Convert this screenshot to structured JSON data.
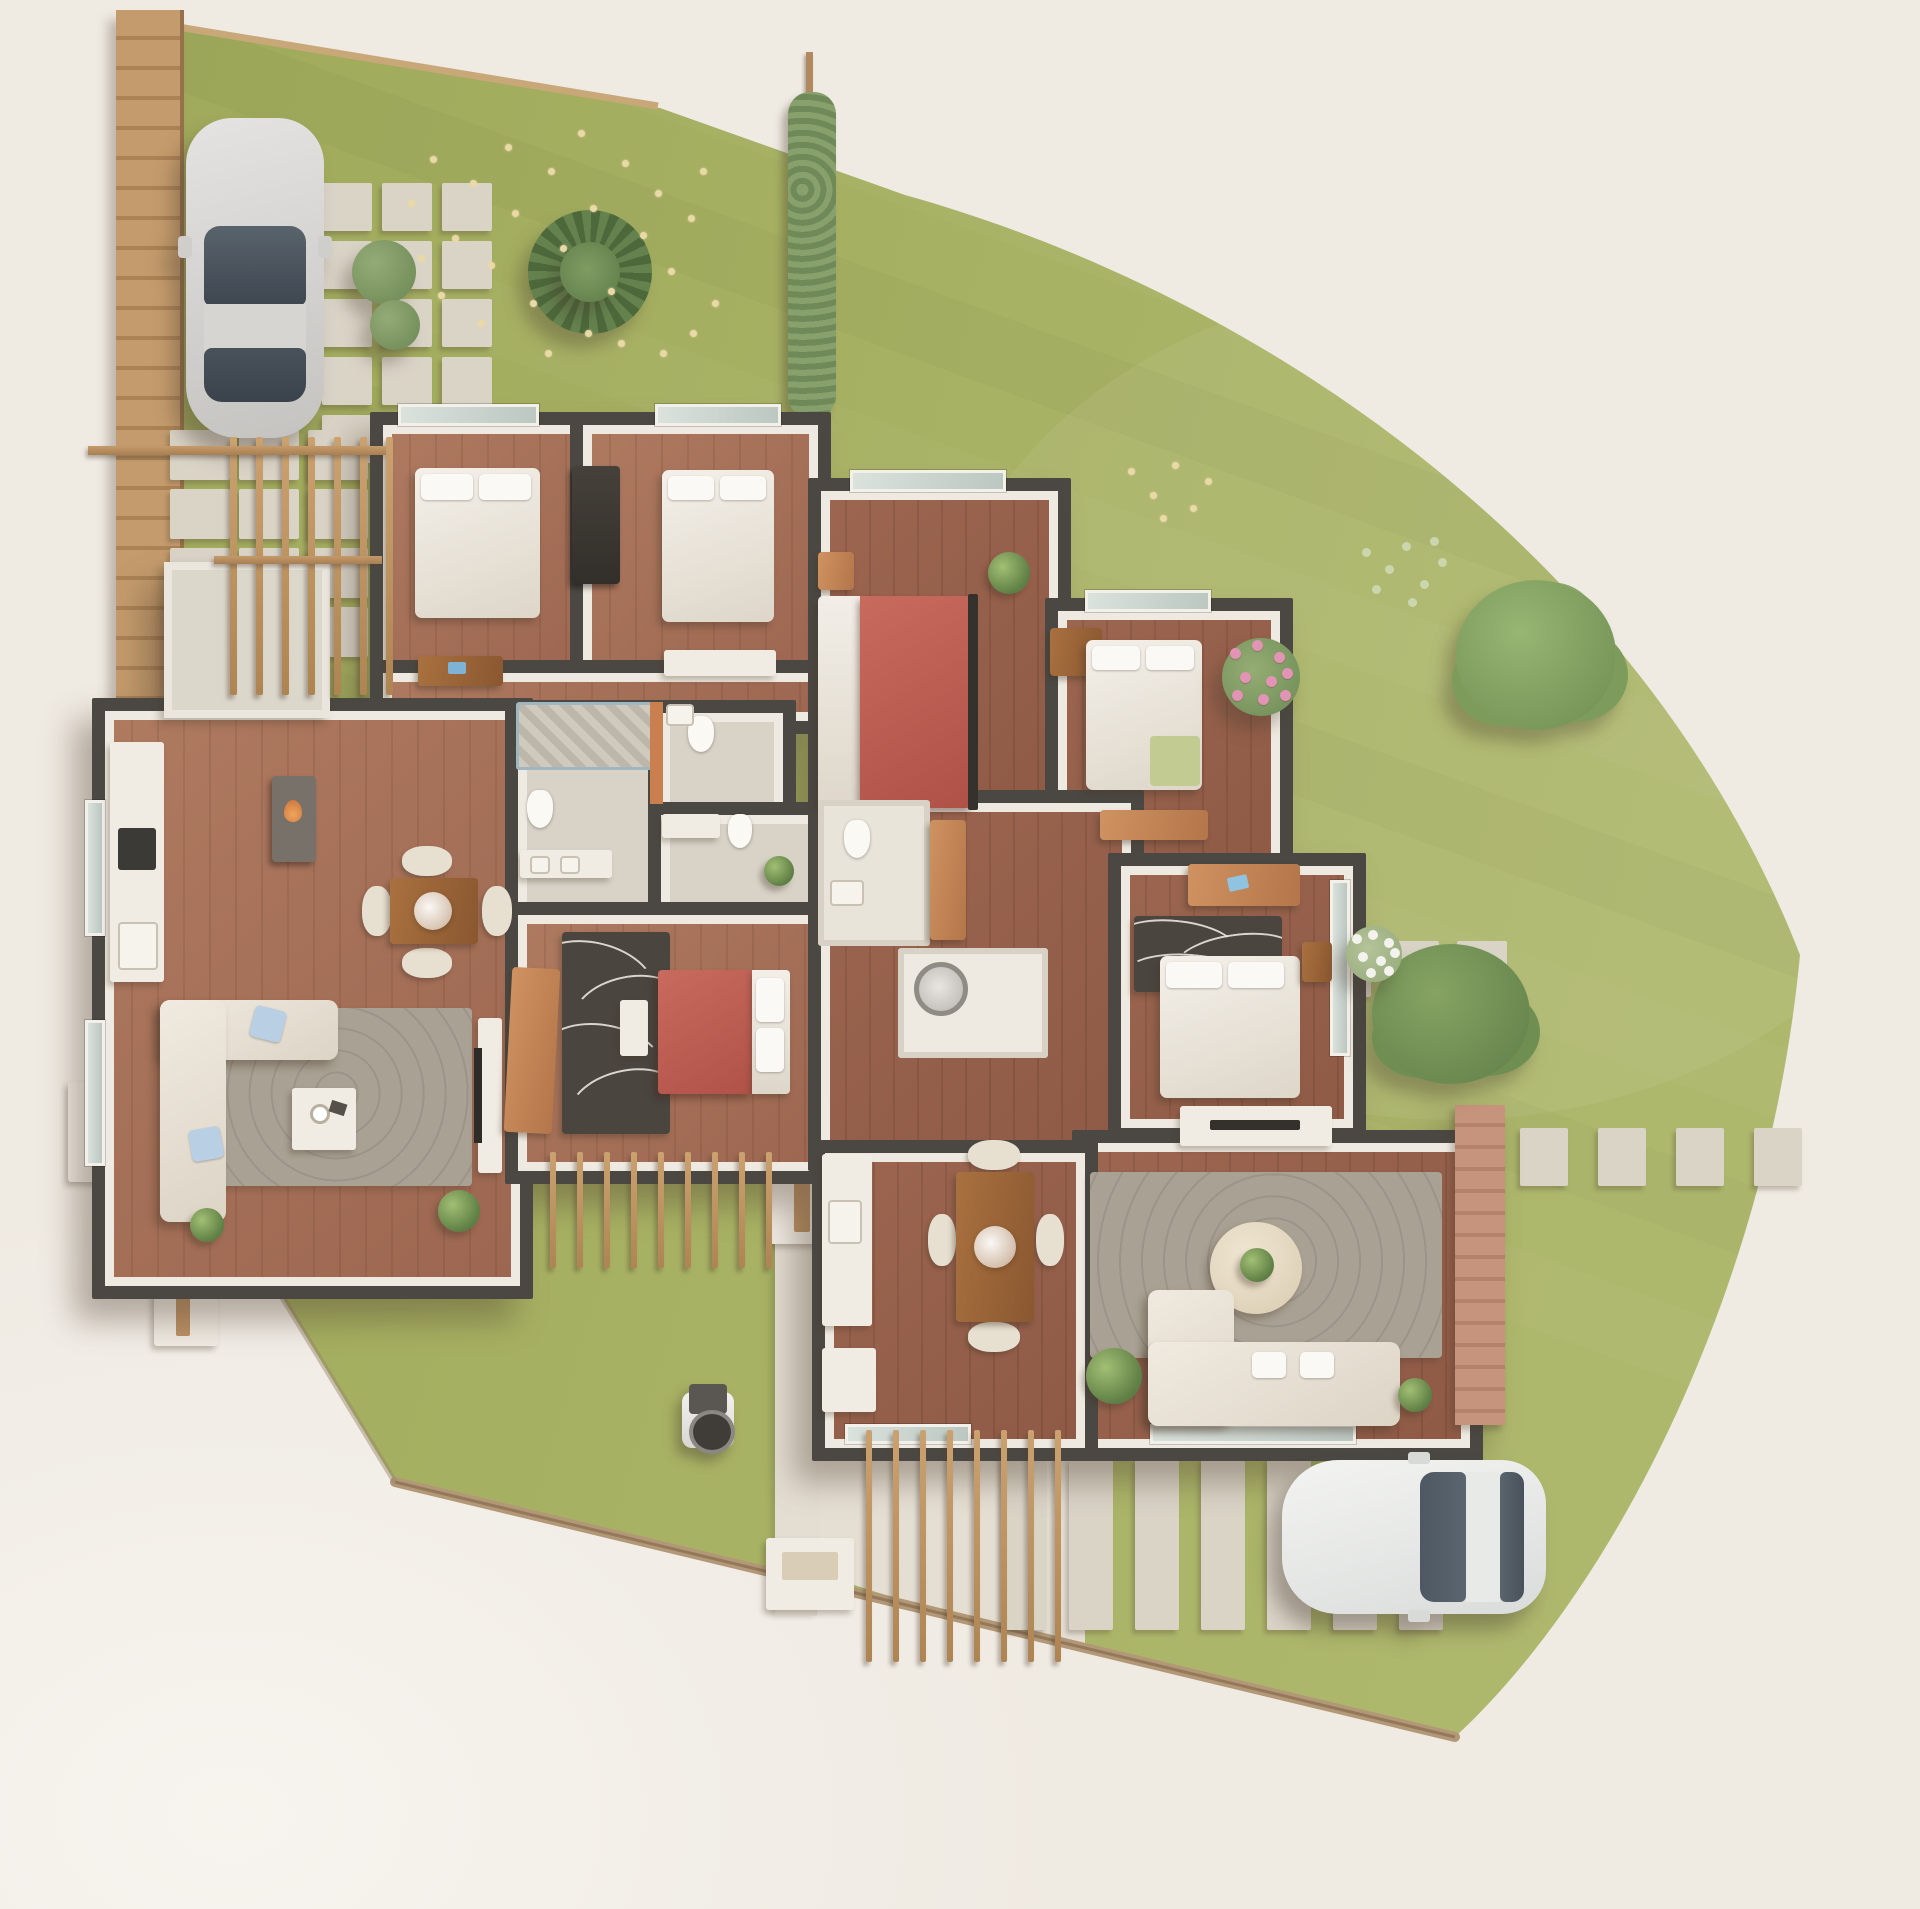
{
  "title": "3d-site-plan-two-unit-residence",
  "palette": {
    "bg": "#efeae2",
    "bg2": "#f7f4ef",
    "grass": "#a6b061",
    "grassd": "#99a556",
    "wall": "#4b4843",
    "wallin": "#efeae1",
    "woodA": "#ae7a60",
    "woodB": "#9c6650",
    "bath": "#d8d2c7",
    "white": "#f0ebe3",
    "cream": "#e8decb",
    "red": "#bf5e53",
    "rug": "#a9a193",
    "rugdark": "#4a453f",
    "wood": "#a06a42",
    "woodlt": "#c58a55",
    "orange": "#c9804e",
    "paver": "#dad4c7",
    "fence": "#bb9064",
    "hedge": "#7c9362",
    "glasscol": "#cdd7d1",
    "dirt": "#b29877",
    "pink": "#e294b4",
    "carbody": "#d9d8d5",
    "carglass": "#515c66",
    "car2body": "#f0f1ef"
  },
  "scene": {
    "lot_path": "M148,22 L660,108 L905,195 C1280,300 1650,570 1800,955 C1768,1292 1612,1592 1455,1737 L395,1482 L165,1105 Z",
    "curb_path": "M395,1482 L1455,1737",
    "edge_top_path": "M148,22 L658,106",
    "driveway_points": "775,1428 1085,1428 1085,1658 775,1560",
    "walkway": {
      "x": 775,
      "y": 1148,
      "w": 42,
      "h": 468
    },
    "fence": {
      "x": 116,
      "y": 10,
      "w": 64,
      "h": 1098
    },
    "hedge": {
      "x": 788,
      "y": 92,
      "w": 48,
      "h": 326
    },
    "hedge_post": {
      "x": 806,
      "y": 52,
      "w": 7,
      "h": 380
    },
    "paver_groups": [
      {
        "name": "entry-grid",
        "x": 322,
        "y": 183,
        "cols": 3,
        "rows": 5,
        "w": 50,
        "h": 48,
        "gx": 10,
        "gy": 10
      },
      {
        "name": "patio-grid",
        "x": 170,
        "y": 430,
        "cols": 3,
        "rows": 4,
        "w": 60,
        "h": 50,
        "gx": 9,
        "gy": 9
      },
      {
        "name": "side-path-row",
        "x": 1253,
        "y": 941,
        "cols": 4,
        "rows": 1,
        "w": 50,
        "h": 56,
        "gx": 18,
        "gy": 0
      },
      {
        "name": "east-path-row",
        "x": 1520,
        "y": 1128,
        "cols": 4,
        "rows": 1,
        "w": 48,
        "h": 58,
        "gx": 30,
        "gy": 0
      },
      {
        "name": "parking-strips",
        "x": 1003,
        "y": 1458,
        "cols": 7,
        "rows": 1,
        "w": 44,
        "h": 172,
        "gx": 22,
        "gy": 0
      }
    ],
    "pergolas": [
      {
        "name": "pergola-northwest",
        "x": 230,
        "y": 437,
        "count": 7,
        "step": 26,
        "w": 7,
        "len": 258
      },
      {
        "name": "pergola-south-unit-a",
        "x": 550,
        "y": 1152,
        "count": 9,
        "step": 27,
        "w": 6,
        "len": 116
      },
      {
        "name": "pergola-driveway",
        "x": 866,
        "y": 1430,
        "count": 8,
        "step": 27,
        "w": 6,
        "len": 232
      }
    ],
    "beams": [
      {
        "x": 88,
        "y": 446,
        "w": 298,
        "h": 9
      },
      {
        "x": 214,
        "y": 556,
        "w": 168,
        "h": 8
      }
    ],
    "flower_specks": [
      [
        408,
        200
      ],
      [
        430,
        156
      ],
      [
        452,
        235
      ],
      [
        470,
        180
      ],
      [
        488,
        262
      ],
      [
        505,
        144
      ],
      [
        512,
        210
      ],
      [
        530,
        300
      ],
      [
        548,
        168
      ],
      [
        560,
        245
      ],
      [
        578,
        130
      ],
      [
        590,
        205
      ],
      [
        608,
        288
      ],
      [
        622,
        160
      ],
      [
        640,
        232
      ],
      [
        655,
        190
      ],
      [
        585,
        330
      ],
      [
        545,
        350
      ],
      [
        618,
        340
      ],
      [
        478,
        320
      ],
      [
        438,
        292
      ],
      [
        418,
        255
      ],
      [
        668,
        268
      ],
      [
        688,
        215
      ],
      [
        700,
        168
      ],
      [
        712,
        300
      ],
      [
        660,
        350
      ],
      [
        690,
        330
      ],
      [
        1128,
        468
      ],
      [
        1150,
        492
      ],
      [
        1172,
        462
      ],
      [
        1190,
        505
      ],
      [
        1205,
        478
      ],
      [
        1160,
        515
      ]
    ],
    "sprigs": [
      [
        1362,
        548
      ],
      [
        1385,
        565
      ],
      [
        1402,
        542
      ],
      [
        1420,
        580
      ],
      [
        1438,
        558
      ],
      [
        1372,
        585
      ],
      [
        1408,
        598
      ],
      [
        1430,
        537
      ]
    ],
    "pink_bush": {
      "x": 1222,
      "y": 638,
      "size": 78,
      "petals": [
        [
          8,
          10
        ],
        [
          30,
          2
        ],
        [
          52,
          14
        ],
        [
          18,
          34
        ],
        [
          44,
          38
        ],
        [
          60,
          30
        ],
        [
          10,
          52
        ],
        [
          36,
          56
        ],
        [
          58,
          52
        ]
      ]
    },
    "white_bush": {
      "x": 1346,
      "y": 926,
      "size": 56,
      "petals": [
        [
          6,
          8
        ],
        [
          22,
          4
        ],
        [
          38,
          12
        ],
        [
          12,
          26
        ],
        [
          30,
          30
        ],
        [
          44,
          22
        ],
        [
          20,
          42
        ],
        [
          38,
          40
        ]
      ]
    }
  }
}
